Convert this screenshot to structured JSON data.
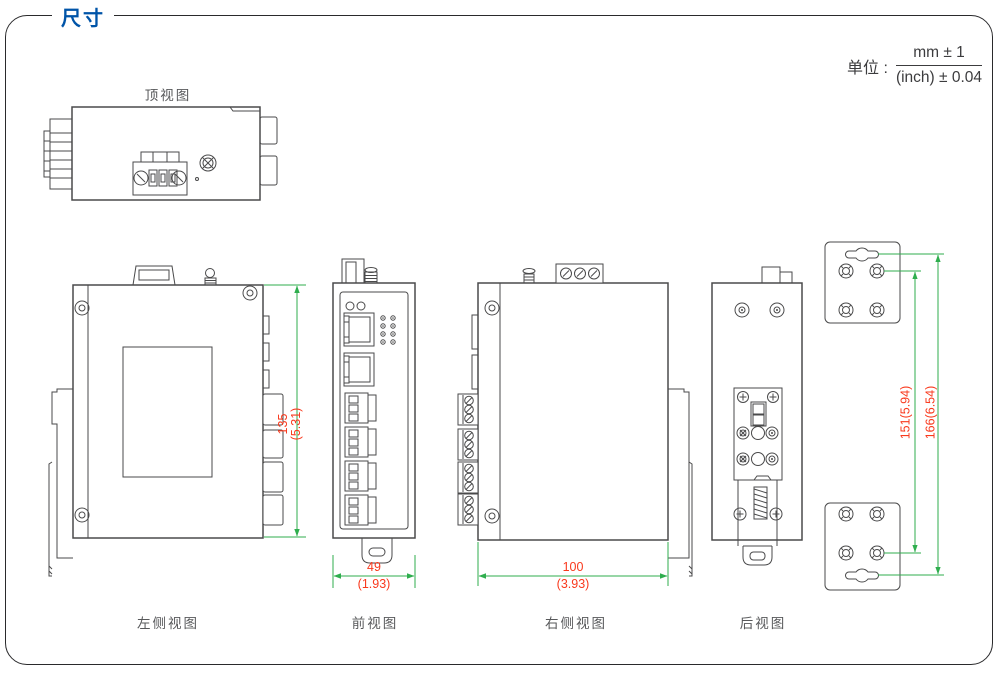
{
  "header": {
    "title": "尺寸"
  },
  "units": {
    "label": "单位 :",
    "numerator": "mm ± 1",
    "denominator": "(inch) ± 0.04"
  },
  "views": {
    "top": {
      "label": "顶视图"
    },
    "left_side": {
      "label": "左侧视图"
    },
    "front": {
      "label": "前视图"
    },
    "right_side": {
      "label": "右侧视图"
    },
    "rear": {
      "label": "后视图"
    }
  },
  "dimensions": {
    "height": {
      "mm": "135",
      "inch": "(5.31)"
    },
    "front_width": {
      "mm": "49",
      "inch": "(1.93)"
    },
    "depth": {
      "mm": "100",
      "inch": "(3.93)"
    },
    "bracket_screw_span": "151(5.94)",
    "bracket_overall_span": "166(6.54)"
  },
  "colors": {
    "accent_blue": "#0054a8",
    "dimension_green": "#2fae4e",
    "dimension_red": "#f9391d",
    "line_gray": "#4a4a4b"
  }
}
